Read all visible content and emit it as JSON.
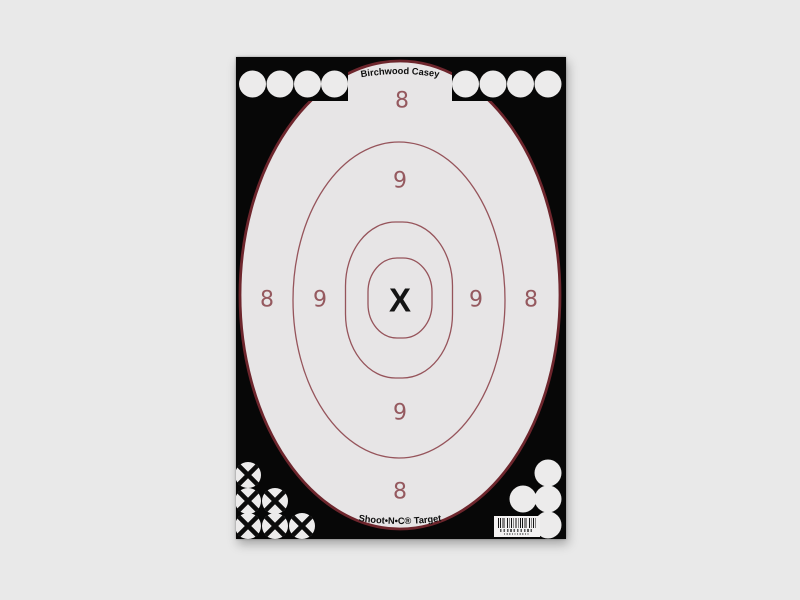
{
  "page": {
    "background_color": "#e9e9e9"
  },
  "target": {
    "brand_top": "Birchwood Casey",
    "brand_bottom": "Shoot•N•C® Target",
    "scores": {
      "eight": "8",
      "nine": "9",
      "x": "X"
    },
    "colors": {
      "body_black": "#070707",
      "zone_fill": "#e7e5e6",
      "outer_edge_red": "#6e262d",
      "ring_red": "#96545b",
      "score_number_red": "#95595f",
      "paster_white": "#ecebeb",
      "cross_black": "#0c0c0c"
    },
    "pasters": {
      "top_left_count": 4,
      "top_right_count": 4,
      "bottom_left_crossed_count": 6,
      "bottom_right_count": 4
    },
    "barcode_present": true
  }
}
